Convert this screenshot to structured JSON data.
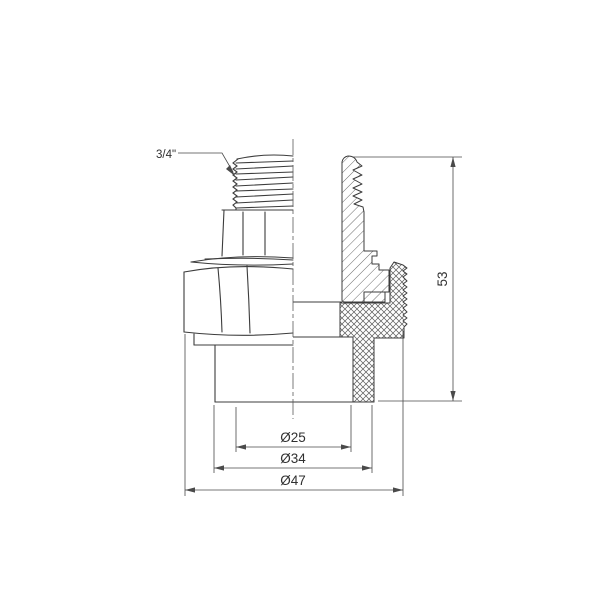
{
  "drawing": {
    "annotations": {
      "thread_size": "3/4\"",
      "height": "53",
      "diameter_inner": "Ø25",
      "diameter_middle": "Ø34",
      "diameter_outer": "Ø47"
    },
    "colors": {
      "outline": "#3c3c3c",
      "dimension_line": "#4a4a4a",
      "hatch": "#5a5a5a",
      "background": "#ffffff"
    }
  }
}
